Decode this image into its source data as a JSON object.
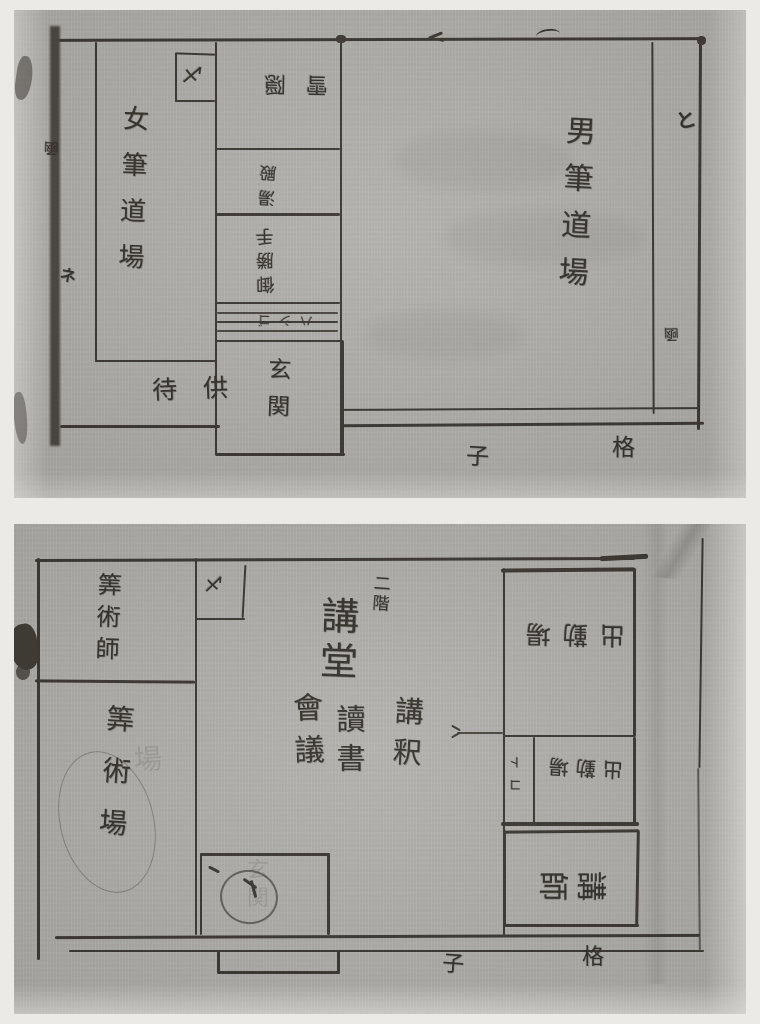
{
  "colors": {
    "paper": "#b2b0ac",
    "ink": "#3b3630",
    "page_background": "#eceae6"
  },
  "floor1": {
    "onna_fude_dojo": "女筆道場",
    "otoko_fude_dojo": "男筆道場",
    "machidomo": "待供",
    "genkan": "玄関",
    "setchin": "雪隠",
    "yudono": "湯殿",
    "okatte": "御勝手",
    "stairs": "ハシゴ",
    "lattice_ko": "子",
    "lattice_koshi": "格",
    "closet_mark": "〆",
    "wall_mark_left_upper": "凾",
    "wall_mark_left_lower": "ネ",
    "wall_mark_right_upper": "と",
    "wall_mark_right_lower": "凾"
  },
  "floor2": {
    "nikai": "二階",
    "koudou": "講堂",
    "koushaku": "講釈",
    "dokusho": "讀書",
    "kaigi": "會議",
    "sanjutsu_shi": "筭術師",
    "sanjutsu_ba": "筭術場",
    "shukkinba_upper": "出勤場",
    "shukkinba_lower": "出勤場",
    "toko": "コト",
    "koushi": "講師",
    "closet_mark": "〆",
    "lattice_ko": "子",
    "lattice_koshi": "格",
    "ghost_ba": "場",
    "ghost_genkan": "玄関"
  }
}
